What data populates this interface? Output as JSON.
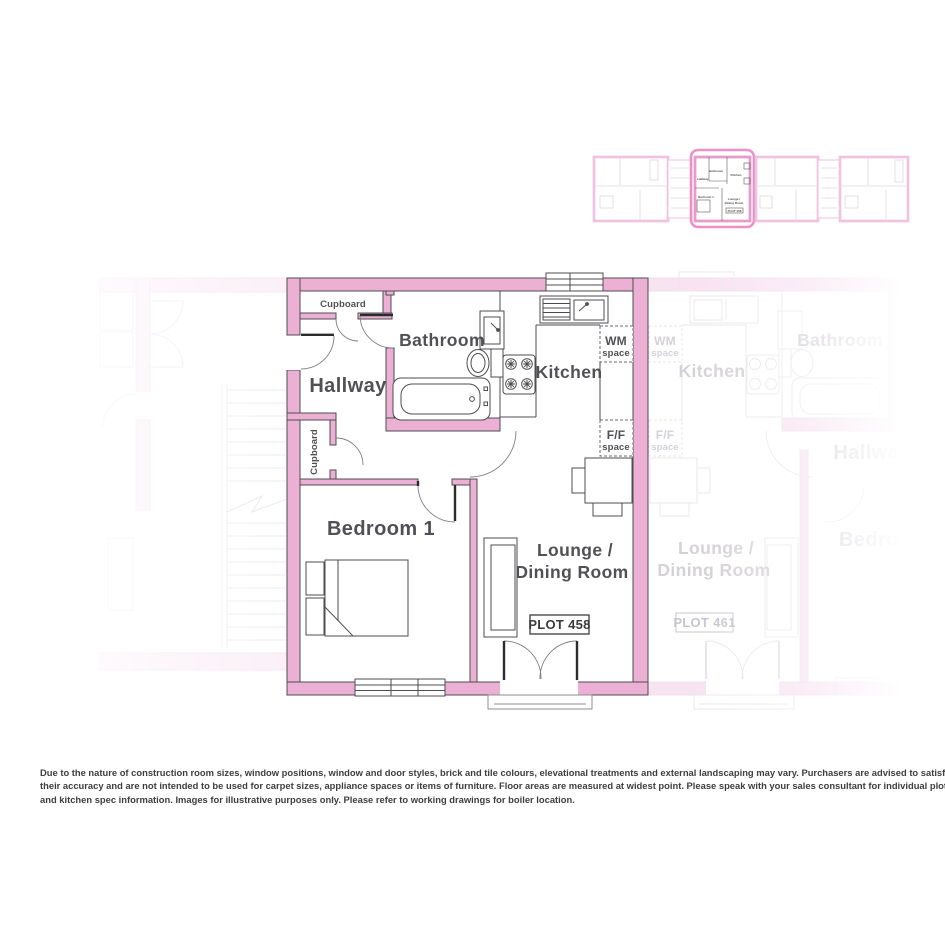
{
  "colors": {
    "wall_pink": "#ecb0d4",
    "outline": "#4e4e50",
    "label_gray": "#515155",
    "faded_wall": "#f8e3f1",
    "faded_line": "#eae6eb",
    "faded_label": "#d5d1d9",
    "highlight_border": "#ee8fc7"
  },
  "main_plan": {
    "plot_badge": "PLOT 458",
    "rooms": {
      "hallway": "Hallway",
      "bathroom": "Bathroom",
      "kitchen": "Kitchen",
      "bedroom": "Bedroom 1",
      "lounge_line1": "Lounge /",
      "lounge_line2": "Dining Room",
      "cupboard_top": "Cupboard",
      "cupboard_side": "Cupboard"
    },
    "appliance_spaces": {
      "wm_line1": "WM",
      "wm_line2": "space",
      "ff_line1": "F/F",
      "ff_line2": "space"
    }
  },
  "adjacent_plan": {
    "plot_badge": "PLOT 461",
    "rooms": {
      "kitchen": "Kitchen",
      "bathroom": "Bathroom",
      "hallway": "Hallway",
      "bedroom": "Bedroom 1",
      "lounge_line1": "Lounge /",
      "lounge_line2": "Dining Room"
    },
    "appliance_spaces": {
      "wm_line1": "WM",
      "wm_line2": "space",
      "ff_line1": "F/F",
      "ff_line2": "space"
    }
  },
  "disclaimer": {
    "line1": "Due to the nature of construction room sizes, window positions, window and door styles, brick and tile colours, elevational treatments and external landscaping may vary. Purchasers are advised to satisfy themselves as to",
    "line2": "their accuracy and are not intended to be used for carpet sizes, appliance spaces or items of furniture. Floor areas are measured at widest point. Please speak with your sales consultant for individual plot, electrical, heating",
    "line3": "and kitchen spec information. Images for illustrative purposes only.  Please refer to working drawings for boiler location."
  }
}
